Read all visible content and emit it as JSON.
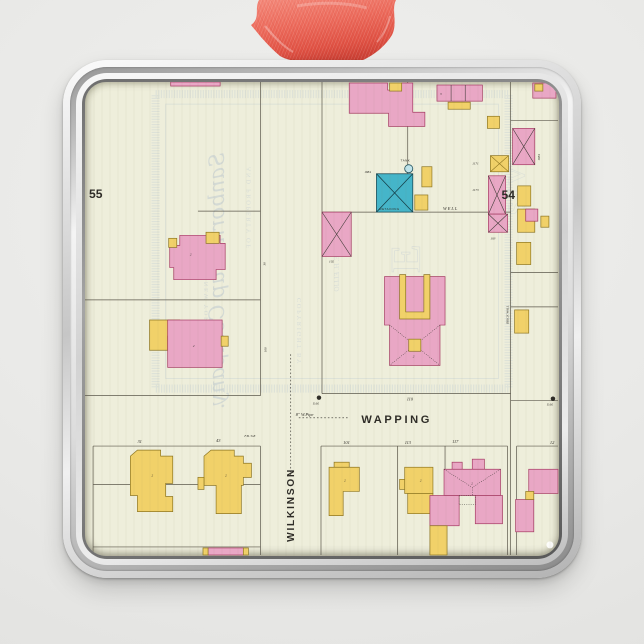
{
  "colors": {
    "paper": "#eeeedb",
    "ink": "#2e2c27",
    "line": "#5c584c",
    "pink": "#e9a7c5",
    "pink_line": "#a63c64",
    "yellow": "#f1d169",
    "yellow_line": "#8f7722",
    "teal": "#45b5c9",
    "wm": "#bfcad1",
    "ribbon": "#ec6a5b",
    "ribbon_dark": "#d7483c",
    "ribbon_light": "#f79c8f"
  },
  "map": {
    "blocks": {
      "left": "55",
      "right": "54"
    },
    "streets": {
      "horizontal": "WAPPING",
      "vertical": "WILKINSON"
    },
    "houses": {
      "h31": "31",
      "h43": "43",
      "h101": "101",
      "h113": "113",
      "h117": "117",
      "h12": "12",
      "h110": "110",
      "h102": "102",
      "h103": "103"
    },
    "stables": {
      "s1171": "1171",
      "s1173": "1173",
      "s1884": "1884"
    },
    "infra": {
      "pipe": "8\" W.Pipe",
      "hydrant": "D.H.",
      "well": "WELL",
      "brick_wall": "BRICK WALL",
      "fire_box": "F.B. 5x8",
      "tank": "TANK",
      "teal_label": "RETAINING",
      "dim30": "30",
      "dim100": "100"
    },
    "marks": {
      "two": "2",
      "three": "3"
    },
    "watermark": {
      "script": "Sanborn Map Company.",
      "property": "AND PROPERTY OF",
      "copyright": "COPYRIGHT BY",
      "city": "NEW YORK.",
      "agent": "E. H. ELLIO",
      "big_center": "NKE",
      "big_right": "SIV"
    }
  }
}
